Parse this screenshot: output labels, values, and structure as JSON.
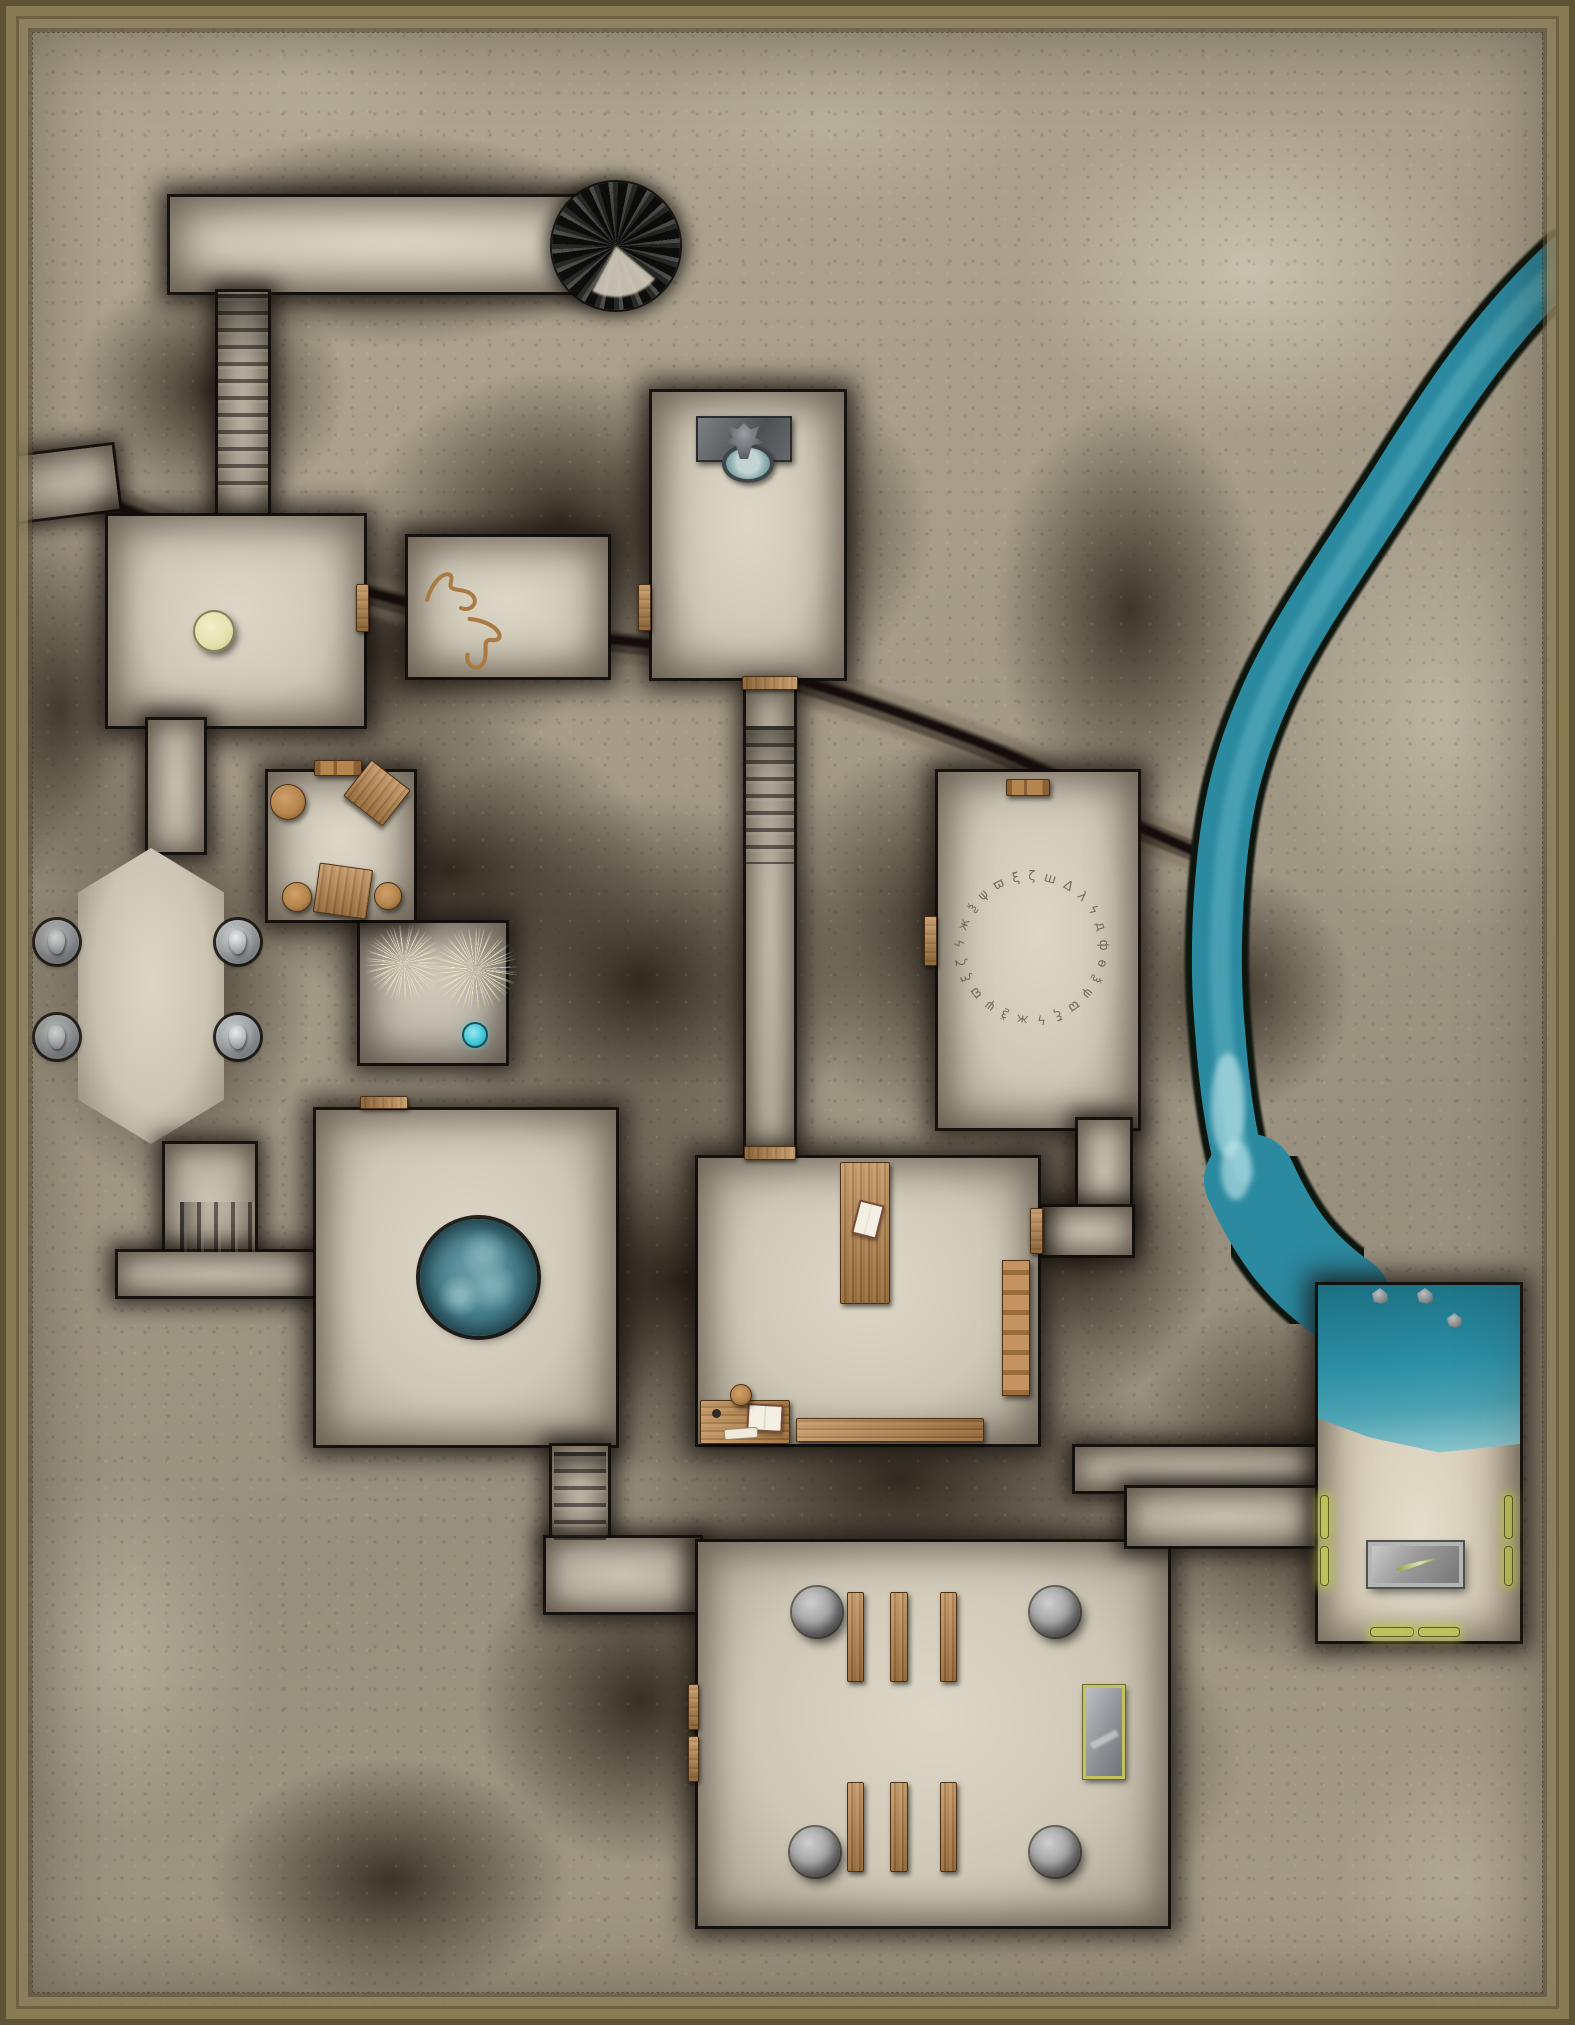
{
  "map": {
    "type": "dungeon-battle-map",
    "colors": {
      "parchment": "#a89e8c",
      "rock": "#2b221a",
      "floor": "#d6cfbf",
      "floor-dark": "#b9b2a2",
      "wood": "#b5854d",
      "wood-dark": "#7a5529",
      "water": "#2b89a0",
      "water-light": "#6fb6c2",
      "pool": "#47808d",
      "crystal": "#41c9da",
      "glow": "#b9bf5a",
      "stone": "#9a9a9a",
      "sand": "#d9d0bd",
      "rune": "#6f675a",
      "frame": "#6d6142",
      "plant": "#eeeccb"
    },
    "rune_text": "ϟ ж ѯ ψ ϖ ξ ζ ш Δ λ ϟ д ф ѳ ѯ ψ ϖ ξ ϟ ж ѯ ψ ϖ ξ ζ ш Δ",
    "features": [
      {
        "type": "room",
        "name": "north-corridor-hall",
        "x": 170,
        "y": 197,
        "w": 452,
        "h": 95,
        "radius": "0 48px 48px 0"
      },
      {
        "type": "corridor",
        "name": "north-stair-corridor",
        "x": 218,
        "y": 292,
        "w": 50,
        "h": 228
      },
      {
        "type": "stairs-overlay",
        "name": "north-stairs",
        "x": 218,
        "y": 294,
        "w": 50,
        "h": 196
      },
      {
        "type": "corridor",
        "name": "west-passage",
        "x": 0,
        "y": 452,
        "w": 116,
        "h": 64,
        "rot": -7
      },
      {
        "type": "room",
        "name": "entrance-hall",
        "x": 108,
        "y": 516,
        "w": 256,
        "h": 210
      },
      {
        "type": "room",
        "name": "rope-room",
        "x": 408,
        "y": 537,
        "w": 200,
        "h": 140
      },
      {
        "type": "room",
        "name": "fountain-room",
        "x": 652,
        "y": 392,
        "w": 192,
        "h": 286
      },
      {
        "type": "corridor",
        "name": "central-corridor",
        "x": 746,
        "y": 690,
        "w": 48,
        "h": 462
      },
      {
        "type": "stairs-overlay",
        "name": "central-stairs",
        "x": 746,
        "y": 726,
        "w": 48,
        "h": 138
      },
      {
        "type": "room",
        "name": "rune-room",
        "x": 938,
        "y": 772,
        "w": 200,
        "h": 356
      },
      {
        "type": "corridor",
        "name": "rune-study-corridor-v",
        "x": 1078,
        "y": 1120,
        "w": 52,
        "h": 100
      },
      {
        "type": "corridor",
        "name": "rune-study-corridor-h",
        "x": 1042,
        "y": 1207,
        "w": 90,
        "h": 48
      },
      {
        "type": "room",
        "name": "study-room",
        "x": 698,
        "y": 1158,
        "w": 340,
        "h": 286
      },
      {
        "type": "room dim",
        "name": "moss-room",
        "x": 360,
        "y": 923,
        "w": 146,
        "h": 140
      },
      {
        "type": "room",
        "name": "table-room",
        "x": 268,
        "y": 772,
        "w": 146,
        "h": 148
      },
      {
        "type": "corridor",
        "name": "hall-chamber-corridor",
        "x": 148,
        "y": 720,
        "w": 56,
        "h": 132
      },
      {
        "type": "room octagon",
        "name": "faces-chamber",
        "x": 78,
        "y": 848,
        "w": 146,
        "h": 296
      },
      {
        "type": "corridor",
        "name": "chamber-stair-landing",
        "x": 165,
        "y": 1144,
        "w": 90,
        "h": 112
      },
      {
        "type": "stairs-overlay h",
        "name": "chamber-stairs",
        "x": 180,
        "y": 1202,
        "w": 75,
        "h": 50
      },
      {
        "type": "corridor",
        "name": "southwest-corridor",
        "x": 118,
        "y": 1252,
        "w": 200,
        "h": 44
      },
      {
        "type": "room",
        "name": "pool-room",
        "x": 316,
        "y": 1110,
        "w": 300,
        "h": 335
      },
      {
        "type": "corridor",
        "name": "temple-stair-corridor",
        "x": 552,
        "y": 1446,
        "w": 56,
        "h": 98
      },
      {
        "type": "stairs-overlay",
        "name": "temple-stairs",
        "x": 554,
        "y": 1452,
        "w": 52,
        "h": 88
      },
      {
        "type": "corridor",
        "name": "temple-vestibule",
        "x": 546,
        "y": 1538,
        "w": 154,
        "h": 74
      },
      {
        "type": "room",
        "name": "temple-room",
        "x": 698,
        "y": 1542,
        "w": 470,
        "h": 384
      },
      {
        "type": "corridor",
        "name": "temple-beach-corridor",
        "x": 1075,
        "y": 1447,
        "w": 247,
        "h": 44
      },
      {
        "type": "corridor",
        "name": "temple-northeast-extension",
        "x": 1127,
        "y": 1488,
        "w": 193,
        "h": 58
      },
      {
        "type": "room beach",
        "name": "beach-room",
        "x": 1318,
        "y": 1285,
        "w": 202,
        "h": 356
      },
      {
        "type": "stairs-spiral",
        "name": "spiral-staircase",
        "x": 552,
        "y": 182,
        "d": 128
      },
      {
        "type": "door",
        "name": "door-hall-rope",
        "x": 356,
        "y": 584,
        "w": 13,
        "h": 48
      },
      {
        "type": "door",
        "name": "door-rope-fountain",
        "x": 638,
        "y": 584,
        "w": 13,
        "h": 47
      },
      {
        "type": "door h",
        "name": "door-fountain-stairs",
        "x": 742,
        "y": 676,
        "w": 56,
        "h": 14
      },
      {
        "type": "door h",
        "name": "door-study-north",
        "x": 744,
        "y": 1146,
        "w": 52,
        "h": 14
      },
      {
        "type": "door",
        "name": "door-study-east",
        "x": 1030,
        "y": 1208,
        "w": 13,
        "h": 46
      },
      {
        "type": "door",
        "name": "door-rune-west",
        "x": 924,
        "y": 916,
        "w": 13,
        "h": 50
      },
      {
        "type": "door h",
        "name": "door-moss-pool",
        "x": 360,
        "y": 1096,
        "w": 48,
        "h": 13
      },
      {
        "type": "bench",
        "name": "bench-table-room-door",
        "x": 314,
        "y": 760,
        "w": 48,
        "h": 16
      },
      {
        "type": "bench",
        "name": "bench-rune-room",
        "x": 1006,
        "y": 779,
        "w": 44,
        "h": 17
      },
      {
        "type": "door",
        "name": "door-temple-west-a",
        "x": 688,
        "y": 1684,
        "w": 11,
        "h": 46
      },
      {
        "type": "door",
        "name": "door-temple-west-b",
        "x": 688,
        "y": 1736,
        "w": 11,
        "h": 46
      },
      {
        "type": "fountain",
        "name": "wall-fountain",
        "x": 696,
        "y": 416,
        "w": 96,
        "h": 46
      },
      {
        "type": "pedestal",
        "name": "stone-pedestal",
        "x": 193,
        "y": 610,
        "d": 42
      },
      {
        "type": "rope",
        "name": "rope-coil-a",
        "x": 420,
        "y": 556,
        "w": 72,
        "h": 62
      },
      {
        "type": "rope",
        "name": "rope-coil-b",
        "x": 452,
        "y": 614,
        "w": 72,
        "h": 64,
        "rot": 80
      },
      {
        "type": "stool",
        "name": "stool-a",
        "x": 270,
        "y": 784,
        "d": 36
      },
      {
        "type": "stool",
        "name": "stool-b",
        "x": 282,
        "y": 882,
        "d": 30
      },
      {
        "type": "stool",
        "name": "stool-c",
        "x": 374,
        "y": 882,
        "d": 28
      },
      {
        "type": "wood-table grain-v",
        "name": "square-table-a",
        "x": 352,
        "y": 770,
        "w": 50,
        "h": 46,
        "rot": 38
      },
      {
        "type": "wood-table grain-v",
        "name": "square-table-b",
        "x": 316,
        "y": 866,
        "w": 54,
        "h": 50,
        "rot": 8
      },
      {
        "type": "medallion",
        "name": "face-medallion-nw",
        "x": 35,
        "y": 920,
        "d": 44
      },
      {
        "type": "medallion",
        "name": "face-medallion-ne",
        "x": 216,
        "y": 920,
        "d": 44
      },
      {
        "type": "medallion",
        "name": "face-medallion-sw",
        "x": 35,
        "y": 1015,
        "d": 44
      },
      {
        "type": "medallion",
        "name": "face-medallion-se",
        "x": 216,
        "y": 1015,
        "d": 44
      },
      {
        "type": "plant",
        "name": "pale-roots-a",
        "x": 362,
        "y": 925,
        "w": 84,
        "h": 76
      },
      {
        "type": "plant",
        "name": "pale-roots-b",
        "x": 434,
        "y": 923,
        "w": 82,
        "h": 92,
        "rot": 30
      },
      {
        "type": "crystal-pool",
        "name": "small-cyan-pool",
        "x": 462,
        "y": 1022,
        "d": 26
      },
      {
        "type": "rune-circle",
        "name": "rune-circle",
        "x": 952,
        "y": 868,
        "d": 160
      },
      {
        "type": "pool",
        "name": "round-water-pool",
        "x": 420,
        "y": 1219,
        "d": 117
      },
      {
        "type": "wood-table grain-v book",
        "name": "study-long-table",
        "x": 840,
        "y": 1162,
        "w": 50,
        "h": 142
      },
      {
        "type": "bookshelf",
        "name": "study-bookshelf",
        "x": 1002,
        "y": 1260,
        "w": 28,
        "h": 136
      },
      {
        "type": "desk",
        "name": "study-desk",
        "x": 700,
        "y": 1400,
        "w": 90,
        "h": 44
      },
      {
        "type": "stool",
        "name": "study-chair",
        "x": 730,
        "y": 1384,
        "d": 22
      },
      {
        "type": "wood-plank grain-h",
        "name": "study-bench",
        "x": 796,
        "y": 1418,
        "w": 188,
        "h": 24
      },
      {
        "type": "boulder",
        "name": "pillar-nw",
        "x": 792,
        "y": 1587,
        "d": 50
      },
      {
        "type": "boulder",
        "name": "pillar-ne",
        "x": 1030,
        "y": 1587,
        "d": 50
      },
      {
        "type": "boulder",
        "name": "pillar-sw",
        "x": 790,
        "y": 1827,
        "d": 50
      },
      {
        "type": "boulder",
        "name": "pillar-se",
        "x": 1030,
        "y": 1827,
        "d": 50
      },
      {
        "type": "wood-plank grain-v",
        "name": "pew-n1",
        "x": 847,
        "y": 1592,
        "w": 17,
        "h": 90
      },
      {
        "type": "wood-plank grain-v",
        "name": "pew-n2",
        "x": 890,
        "y": 1592,
        "w": 18,
        "h": 90
      },
      {
        "type": "wood-plank grain-v",
        "name": "pew-n3",
        "x": 940,
        "y": 1592,
        "w": 17,
        "h": 90
      },
      {
        "type": "wood-plank grain-v",
        "name": "pew-s1",
        "x": 847,
        "y": 1782,
        "w": 17,
        "h": 90
      },
      {
        "type": "wood-plank grain-v",
        "name": "pew-s2",
        "x": 890,
        "y": 1782,
        "w": 18,
        "h": 90
      },
      {
        "type": "wood-plank grain-v",
        "name": "pew-s3",
        "x": 940,
        "y": 1782,
        "w": 17,
        "h": 90
      },
      {
        "type": "altar",
        "name": "stone-altar",
        "x": 1083,
        "y": 1685,
        "w": 42,
        "h": 94
      },
      {
        "type": "slab",
        "name": "metal-slab",
        "x": 1368,
        "y": 1542,
        "w": 95,
        "h": 45
      },
      {
        "type": "glow",
        "name": "glow-bar-w1",
        "x": 1320,
        "y": 1495,
        "w": 9,
        "h": 44
      },
      {
        "type": "glow",
        "name": "glow-bar-w2",
        "x": 1320,
        "y": 1546,
        "w": 9,
        "h": 40
      },
      {
        "type": "glow",
        "name": "glow-bar-e1",
        "x": 1504,
        "y": 1495,
        "w": 9,
        "h": 44
      },
      {
        "type": "glow",
        "name": "glow-bar-e2",
        "x": 1504,
        "y": 1546,
        "w": 9,
        "h": 40
      },
      {
        "type": "glow",
        "name": "glow-bar-s1",
        "x": 1370,
        "y": 1627,
        "w": 44,
        "h": 10
      },
      {
        "type": "glow",
        "name": "glow-bar-s2",
        "x": 1418,
        "y": 1627,
        "w": 42,
        "h": 10
      },
      {
        "type": "rock",
        "name": "water-rock-a",
        "x": 1372,
        "y": 1288,
        "d": 16
      },
      {
        "type": "rock",
        "name": "water-rock-b",
        "x": 1417,
        "y": 1288,
        "d": 16
      },
      {
        "type": "rock",
        "name": "water-rock-c",
        "x": 1447,
        "y": 1313,
        "d": 15
      }
    ]
  }
}
